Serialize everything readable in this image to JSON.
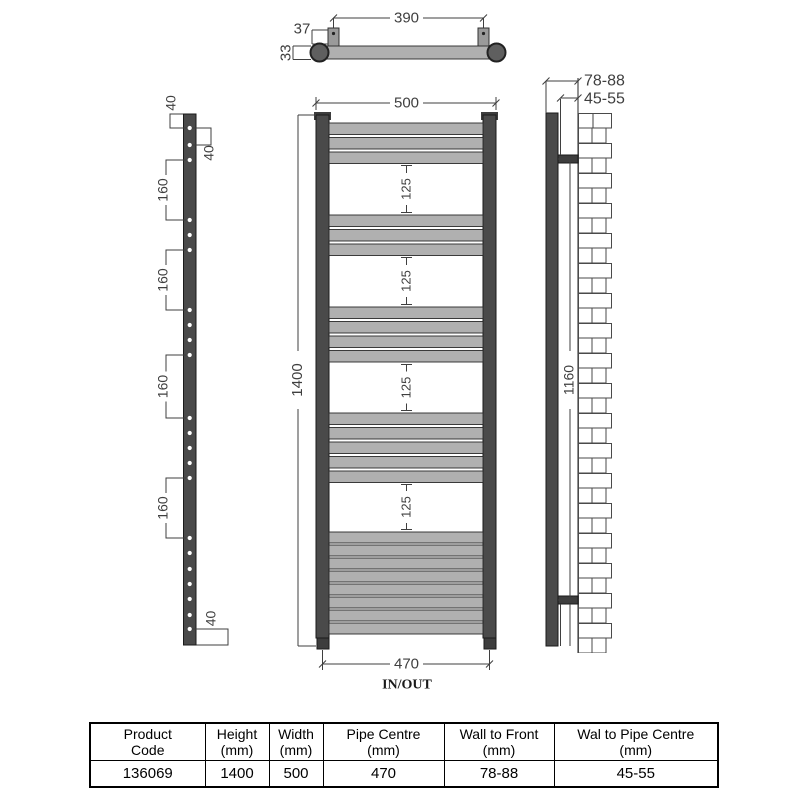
{
  "drawing": {
    "top_view": {
      "width": "390",
      "bracket_depth": "37",
      "rail_thickness": "33"
    },
    "left_view": {
      "top_hole_offset": "40",
      "hole_pair_spacing": "40",
      "group_spacings": [
        "160",
        "160",
        "160",
        "160"
      ],
      "bottom_hole_offset": "40"
    },
    "front_view": {
      "overall_width": "500",
      "overall_height": "1400",
      "panel_gaps": [
        "125",
        "125",
        "125",
        "125"
      ],
      "pipe_centres": "470",
      "inout": "IN/OUT"
    },
    "side_view": {
      "wall_to_front": "78-88",
      "wall_to_pipe_centre": "45-55",
      "bracket_centres": "1160"
    }
  },
  "table": {
    "headers": [
      {
        "line1": "Product",
        "line2": "Code"
      },
      {
        "line1": "Height",
        "line2": "(mm)"
      },
      {
        "line1": "Width",
        "line2": "(mm)"
      },
      {
        "line1": "Pipe Centre",
        "line2": "(mm)"
      },
      {
        "line1": "Wall to Front",
        "line2": "(mm)"
      },
      {
        "line1": "Wal to Pipe Centre",
        "line2": "(mm)"
      }
    ],
    "values": [
      "136069",
      "1400",
      "500",
      "470",
      "78-88",
      "45-55"
    ]
  },
  "colors": {
    "rail_dark": "#4a4a4a",
    "bar_gray": "#b0b0b0",
    "line": "#3f3f3f",
    "background": "#ffffff"
  }
}
